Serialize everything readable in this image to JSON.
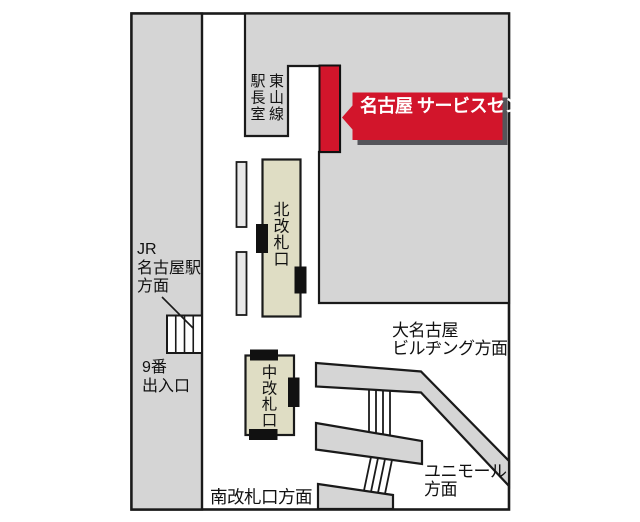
{
  "map": {
    "callout": {
      "line1": "名古屋",
      "line2": "サービスセンター"
    },
    "labels": {
      "station_master_room": "駅長室",
      "higashiyama_line": "東山線",
      "north_gate": "北改札口",
      "middle_gate": "中改札口",
      "jr_line1": "JR",
      "jr_line2": "名古屋駅",
      "jr_line3": "方面",
      "exit9_line1": "9番",
      "exit9_line2": "出入口",
      "south_gate": "南改札口方面",
      "dai_nagoya_line1": "大名古屋",
      "dai_nagoya_line2": "ビルヂング方面",
      "unimall_line1": "ユニモール",
      "unimall_line2": "方面"
    },
    "colors": {
      "accent_red": "#d2152b",
      "block_gray": "#d5d5d5",
      "gate_beige": "#dfddc4",
      "pillar_gray": "#e9e9e9",
      "shadow_gray": "#55555a",
      "line_black": "#1a1a1a",
      "callout_text": "#ffffff"
    }
  }
}
